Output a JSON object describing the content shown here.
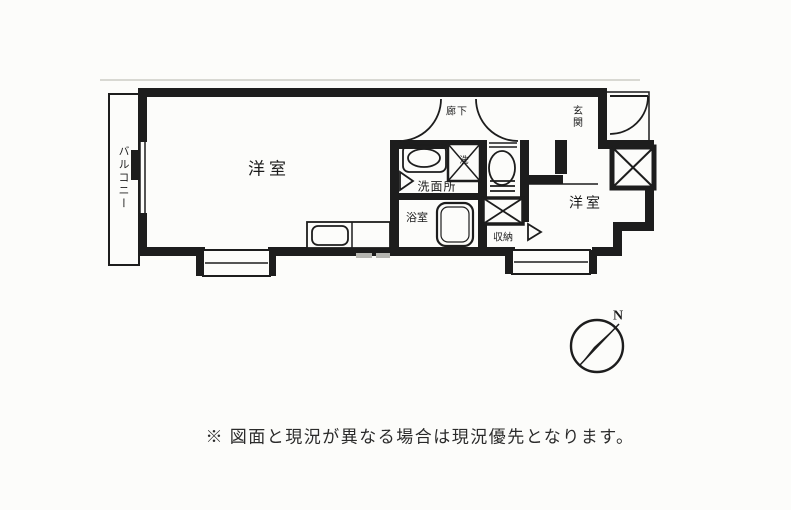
{
  "floor_plan": {
    "rooms": {
      "balcony": "バルコニー",
      "room_large": "洋室",
      "hallway": "廊下",
      "entrance": "玄関",
      "washroom": "洗面所",
      "bathroom": "浴室",
      "storage": "収納",
      "room_right": "洋室",
      "washer_mark": "洗"
    },
    "compass": {
      "north_label": "N"
    },
    "colors": {
      "ink": "#1d1d1d",
      "paper": "#fcfcfa",
      "faint_scan_line": "#d8d8d2"
    }
  },
  "footer": {
    "disclaimer": "※ 図面と現況が異なる場合は現況優先となります。"
  }
}
